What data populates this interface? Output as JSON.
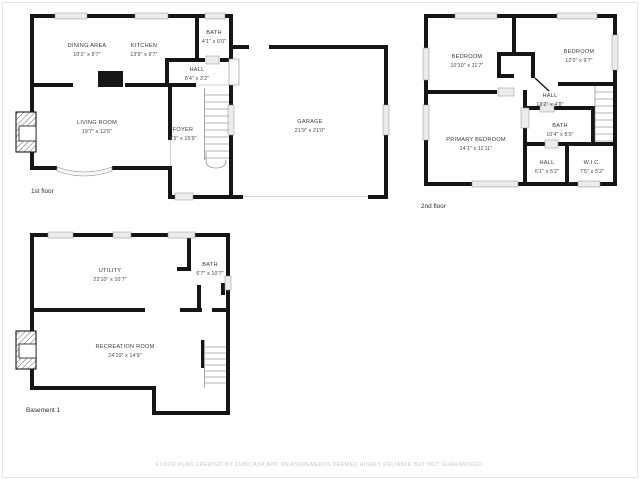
{
  "colors": {
    "wall": "#161616",
    "window_fill": "#ececec",
    "label_text": "#3b3b3b",
    "disclaimer_text": "#c7c7c7",
    "background": "#ffffff"
  },
  "floors": [
    {
      "label": "1st floor",
      "rooms": [
        {
          "name": "DINING AREA",
          "dims": "10'1\" x 9'7\""
        },
        {
          "name": "KITCHEN",
          "dims": "13'9\" x 9'7\""
        },
        {
          "name": "BATH",
          "dims": "4'1\" x 6'0\""
        },
        {
          "name": "HALL",
          "dims": "8'4\" x 3'2\""
        },
        {
          "name": "LIVING ROOM",
          "dims": "19'7\" x 12'6\""
        },
        {
          "name": "FOYER",
          "dims": "8'5\" x 15'9\""
        },
        {
          "name": "GARAGE",
          "dims": "21'9\" x 21'0\""
        }
      ]
    },
    {
      "label": "2nd floor",
      "rooms": [
        {
          "name": "BEDROOM",
          "dims": "10'10\" x 11'7\""
        },
        {
          "name": "BEDROOM",
          "dims": "12'0\" x 9'7\""
        },
        {
          "name": "HALL",
          "dims": "13'2\" x 4'8\""
        },
        {
          "name": "BATH",
          "dims": "10'4\" x 5'0\""
        },
        {
          "name": "PRIMARY BEDROOM",
          "dims": "14'1\" x 11'11\""
        },
        {
          "name": "HALL",
          "dims": "6'1\" x 5'2\""
        },
        {
          "name": "W.I.C.",
          "dims": "7'5\" x 5'2\""
        }
      ]
    },
    {
      "label": "Basement 1",
      "rooms": [
        {
          "name": "UTILITY",
          "dims": "22'10\" x 10'7\""
        },
        {
          "name": "BATH",
          "dims": "6'7\" x 10'7\""
        },
        {
          "name": "RECREATION ROOM",
          "dims": "24'10\" x 14'9\""
        }
      ]
    }
  ],
  "footer": {
    "disclaimer": "FLOOR PLAN CREATED BY CUBICASA APP. MEASUREMENTS DEEMED HIGHLY RELIABLE BUT NOT GUARANTEED."
  }
}
